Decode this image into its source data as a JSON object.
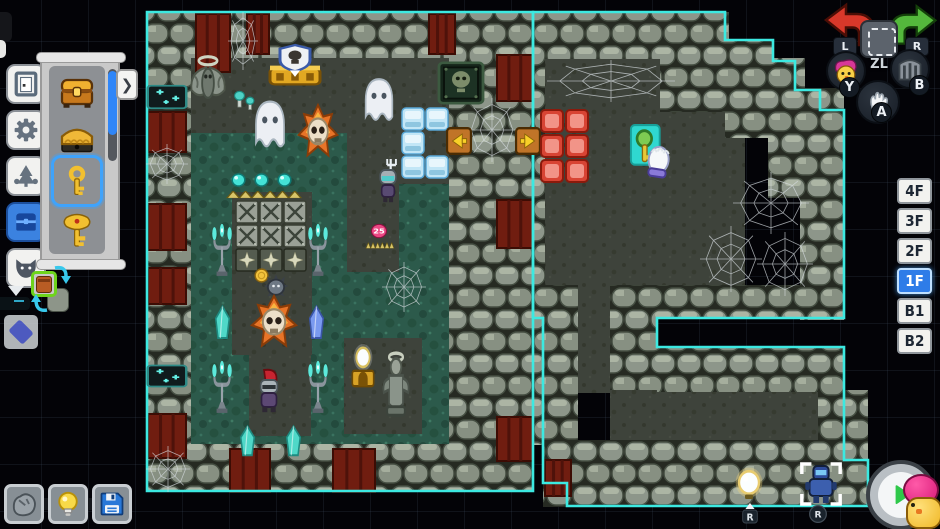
{
  "app": {
    "name": "dungeon-editor"
  },
  "colors": {
    "outline_teal": "#3ce9e1",
    "selection_blue": "#3fa3fb",
    "active_floor_blue": "#2e7ce8",
    "undo_red": "#d8382a",
    "redo_green": "#54b83c",
    "play_green": "#2ec84a"
  },
  "toolbar": {
    "buttons": [
      {
        "name": "door"
      },
      {
        "name": "gear"
      },
      {
        "name": "nature"
      },
      {
        "name": "chest",
        "active": true
      },
      {
        "name": "wolf"
      }
    ]
  },
  "palette": {
    "expand_arrow": "❯",
    "items": [
      {
        "name": "golden-chest"
      },
      {
        "name": "golden-bed"
      },
      {
        "name": "small-key",
        "selected": true
      },
      {
        "name": "boss-key"
      }
    ]
  },
  "preview": {
    "selected_item": "pot"
  },
  "bottom_toolbar": {
    "buttons": [
      {
        "name": "rock"
      },
      {
        "name": "bulb"
      },
      {
        "name": "save"
      }
    ]
  },
  "controller": {
    "l": "L",
    "zl": "ZL",
    "r": "R",
    "y": "Y",
    "b": "B",
    "a": "A"
  },
  "floors": {
    "active": "1F",
    "items": [
      {
        "label": "4F"
      },
      {
        "label": "3F"
      },
      {
        "label": "2F"
      },
      {
        "label": "1F"
      },
      {
        "label": "B1"
      },
      {
        "label": "B2"
      }
    ]
  },
  "map": {
    "outlines": [
      {
        "d": "M147,12 H533 V491 H147 Z"
      },
      {
        "d": "M533,12 H725 V40 H773 V61 H795 V90 H820 V110 H844 V318 H657 V347 H844 V460 H868 V506 H567 V483 H543 V318 H533 Z"
      }
    ],
    "moss": [
      [
        190,
        57,
        262,
        388
      ]
    ],
    "paths": [
      [
        190,
        57,
        262,
        76
      ],
      [
        232,
        192,
        80,
        163
      ],
      [
        249,
        350,
        62,
        86
      ],
      [
        347,
        130,
        52,
        142
      ],
      [
        397,
        102,
        56,
        82
      ],
      [
        344,
        338,
        78,
        96
      ],
      [
        543,
        58,
        202,
        230
      ],
      [
        577,
        285,
        34,
        108
      ],
      [
        610,
        388,
        212,
        54
      ]
    ],
    "walls": [
      [
        147,
        12,
        386,
        46
      ],
      [
        147,
        444,
        386,
        48
      ],
      [
        147,
        57,
        44,
        388
      ],
      [
        449,
        57,
        96,
        388
      ],
      [
        533,
        12,
        196,
        47
      ],
      [
        660,
        40,
        113,
        72
      ],
      [
        725,
        58,
        80,
        80
      ],
      [
        768,
        88,
        76,
        110
      ],
      [
        800,
        150,
        44,
        170
      ],
      [
        657,
        285,
        187,
        33
      ],
      [
        657,
        347,
        187,
        45
      ],
      [
        543,
        285,
        35,
        222
      ],
      [
        610,
        285,
        48,
        105
      ],
      [
        567,
        440,
        301,
        67
      ],
      [
        818,
        390,
        50,
        52
      ]
    ],
    "banners": [
      [
        148,
        112,
        38,
        40
      ],
      [
        148,
        204,
        38,
        46
      ],
      [
        148,
        268,
        38,
        36
      ],
      [
        148,
        414,
        38,
        44
      ],
      [
        196,
        14,
        34,
        58
      ],
      [
        247,
        14,
        22,
        40
      ],
      [
        429,
        14,
        26,
        40
      ],
      [
        497,
        55,
        36,
        46
      ],
      [
        497,
        200,
        36,
        48
      ],
      [
        497,
        417,
        36,
        44
      ],
      [
        230,
        449,
        40,
        43
      ],
      [
        333,
        449,
        42,
        43
      ],
      [
        545,
        460,
        26,
        36
      ]
    ],
    "webs": [
      [
        228,
        12,
        30,
        58
      ],
      [
        146,
        144,
        42,
        40
      ],
      [
        146,
        446,
        44,
        46
      ],
      [
        466,
        98,
        52,
        64
      ],
      [
        382,
        262,
        44,
        50
      ],
      [
        547,
        60,
        128,
        42
      ],
      [
        700,
        226,
        62,
        66
      ],
      [
        733,
        172,
        76,
        62
      ],
      [
        757,
        232,
        56,
        64
      ]
    ],
    "entities": [
      {
        "type": "mothstatue",
        "x": 186,
        "y": 54,
        "w": 44,
        "h": 54
      },
      {
        "type": "shrinegold",
        "x": 265,
        "y": 45,
        "w": 60,
        "h": 45
      },
      {
        "type": "goblinplaque",
        "x": 437,
        "y": 61,
        "w": 48,
        "h": 44
      },
      {
        "type": "fairyjar",
        "x": 146,
        "y": 82,
        "w": 42,
        "h": 30
      },
      {
        "type": "fairyjar",
        "x": 146,
        "y": 362,
        "w": 42,
        "h": 28
      },
      {
        "type": "mushrooms",
        "x": 233,
        "y": 82,
        "w": 26,
        "h": 30
      },
      {
        "type": "ghost",
        "x": 249,
        "y": 97,
        "w": 42,
        "h": 55
      },
      {
        "type": "ghost",
        "x": 359,
        "y": 75,
        "w": 40,
        "h": 50
      },
      {
        "type": "fireskull",
        "x": 297,
        "y": 105,
        "w": 42,
        "h": 55
      },
      {
        "type": "icetile",
        "x": 401,
        "y": 107,
        "w": 24,
        "h": 24
      },
      {
        "type": "icetile",
        "x": 425,
        "y": 107,
        "w": 24,
        "h": 24
      },
      {
        "type": "icetile",
        "x": 401,
        "y": 131,
        "w": 24,
        "h": 24
      },
      {
        "type": "icetile",
        "x": 401,
        "y": 155,
        "w": 24,
        "h": 24
      },
      {
        "type": "icetile",
        "x": 425,
        "y": 155,
        "w": 24,
        "h": 24
      },
      {
        "type": "doormarker",
        "x": 446,
        "y": 127,
        "w": 26,
        "h": 28,
        "dir": "left"
      },
      {
        "type": "doormarker",
        "x": 515,
        "y": 127,
        "w": 26,
        "h": 28,
        "dir": "right"
      },
      {
        "type": "orbtorch",
        "x": 229,
        "y": 171,
        "w": 19,
        "h": 18
      },
      {
        "type": "orbtorch",
        "x": 252,
        "y": 171,
        "w": 19,
        "h": 18
      },
      {
        "type": "orbtorch",
        "x": 275,
        "y": 171,
        "w": 19,
        "h": 18
      },
      {
        "type": "spikestrip",
        "x": 227,
        "y": 188,
        "w": 74,
        "h": 12
      },
      {
        "type": "spikeplate",
        "x": 235,
        "y": 200,
        "w": 24,
        "h": 24
      },
      {
        "type": "spikeplate",
        "x": 259,
        "y": 200,
        "w": 24,
        "h": 24
      },
      {
        "type": "spikeplate",
        "x": 283,
        "y": 200,
        "w": 24,
        "h": 24
      },
      {
        "type": "spikeplate",
        "x": 235,
        "y": 224,
        "w": 24,
        "h": 24
      },
      {
        "type": "spikeplate",
        "x": 259,
        "y": 224,
        "w": 24,
        "h": 24
      },
      {
        "type": "spikeplate",
        "x": 283,
        "y": 224,
        "w": 24,
        "h": 24
      },
      {
        "type": "starplate",
        "x": 235,
        "y": 248,
        "w": 24,
        "h": 24
      },
      {
        "type": "starplate",
        "x": 259,
        "y": 248,
        "w": 24,
        "h": 24
      },
      {
        "type": "starplate",
        "x": 283,
        "y": 248,
        "w": 24,
        "h": 24
      },
      {
        "type": "candelabra",
        "x": 209,
        "y": 225,
        "w": 26,
        "h": 52
      },
      {
        "type": "candelabra",
        "x": 305,
        "y": 225,
        "w": 26,
        "h": 52
      },
      {
        "type": "candelabra",
        "x": 209,
        "y": 362,
        "w": 26,
        "h": 52
      },
      {
        "type": "candelabra",
        "x": 305,
        "y": 362,
        "w": 26,
        "h": 52
      },
      {
        "type": "forkknight",
        "x": 369,
        "y": 159,
        "w": 38,
        "h": 48
      },
      {
        "type": "badge",
        "x": 370,
        "y": 223,
        "w": 18,
        "h": 16,
        "label": "25"
      },
      {
        "type": "spikestrip",
        "x": 366,
        "y": 240,
        "w": 28,
        "h": 10
      },
      {
        "type": "coin",
        "x": 253,
        "y": 267,
        "w": 17,
        "h": 17
      },
      {
        "type": "mine",
        "x": 261,
        "y": 272,
        "w": 30,
        "h": 28
      },
      {
        "type": "fireskull",
        "x": 250,
        "y": 296,
        "w": 48,
        "h": 54
      },
      {
        "type": "crystal",
        "x": 209,
        "y": 305,
        "w": 27,
        "h": 36,
        "color": "teal"
      },
      {
        "type": "crystal",
        "x": 303,
        "y": 305,
        "w": 27,
        "h": 36,
        "color": "blue"
      },
      {
        "type": "crystal",
        "x": 234,
        "y": 425,
        "w": 27,
        "h": 33,
        "color": "teal"
      },
      {
        "type": "crystal",
        "x": 280,
        "y": 425,
        "w": 27,
        "h": 33,
        "color": "teal"
      },
      {
        "type": "knight",
        "x": 249,
        "y": 368,
        "w": 40,
        "h": 48
      },
      {
        "type": "lamppedestal",
        "x": 347,
        "y": 344,
        "w": 32,
        "h": 46
      },
      {
        "type": "statue",
        "x": 375,
        "y": 350,
        "w": 42,
        "h": 68
      },
      {
        "type": "redtile",
        "x": 540,
        "y": 109,
        "w": 24,
        "h": 24
      },
      {
        "type": "redtile",
        "x": 565,
        "y": 109,
        "w": 24,
        "h": 24
      },
      {
        "type": "redtile",
        "x": 540,
        "y": 134,
        "w": 24,
        "h": 24
      },
      {
        "type": "redtile",
        "x": 565,
        "y": 134,
        "w": 24,
        "h": 24
      },
      {
        "type": "redtile",
        "x": 540,
        "y": 159,
        "w": 24,
        "h": 24
      },
      {
        "type": "redtile",
        "x": 565,
        "y": 159,
        "w": 24,
        "h": 24
      },
      {
        "type": "keycursor",
        "x": 629,
        "y": 123,
        "w": 46,
        "h": 50
      },
      {
        "type": "weborb",
        "x": 733,
        "y": 466,
        "w": 32,
        "h": 36
      },
      {
        "type": "rbadge",
        "x": 739,
        "y": 502,
        "w": 22,
        "h": 24,
        "label": "R"
      },
      {
        "type": "robot",
        "x": 798,
        "y": 460,
        "w": 46,
        "h": 48
      },
      {
        "type": "rcircle",
        "x": 808,
        "y": 504,
        "w": 20,
        "h": 20,
        "label": "R"
      }
    ]
  }
}
